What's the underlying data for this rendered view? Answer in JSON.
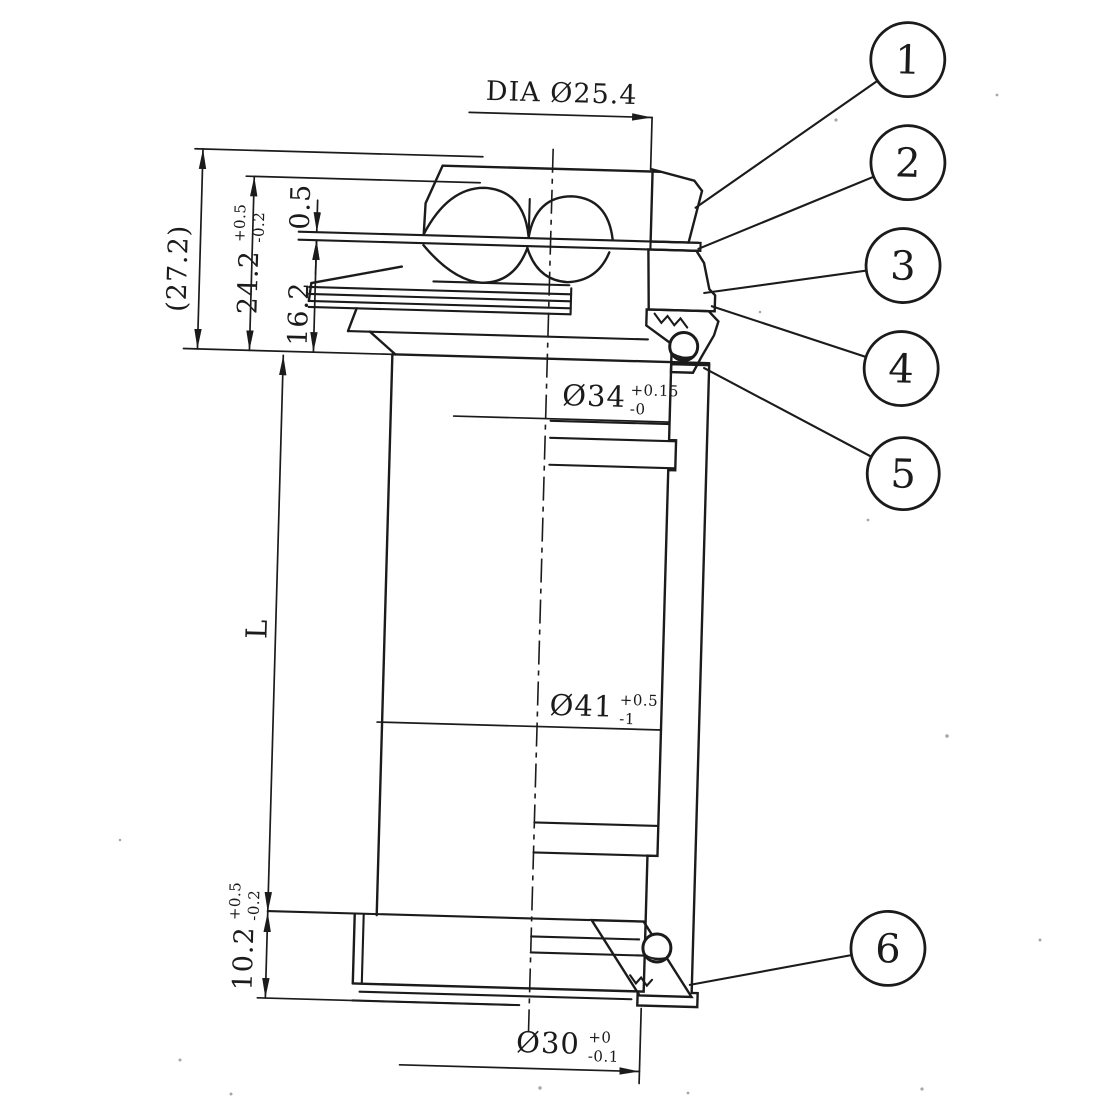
{
  "dimensions": {
    "dia_label": "DIA Ø25.4",
    "overall": "(27.2)",
    "upper_stack": {
      "value": "24.2",
      "tol_plus": "+0.5",
      "tol_minus": "-0.2"
    },
    "washer": "0.5",
    "upper_race": "16.2",
    "length": "L",
    "lower_stack": {
      "value": "10.2",
      "tol_plus": "+0.5",
      "tol_minus": "-0.2"
    },
    "bore_top": {
      "value": "Ø34",
      "tol_plus": "+0.15",
      "tol_minus": "-0"
    },
    "bore_mid": {
      "value": "Ø41",
      "tol_plus": "+0.5",
      "tol_minus": "-1"
    },
    "bore_bottom": {
      "value": "Ø30",
      "tol_plus": "+0",
      "tol_minus": "-0.1"
    }
  },
  "callouts": [
    {
      "number": "1"
    },
    {
      "number": "2"
    },
    {
      "number": "3"
    },
    {
      "number": "4"
    },
    {
      "number": "5"
    },
    {
      "number": "6"
    }
  ],
  "colors": {
    "ink": "#1b1b1b",
    "paper": "#ffffff"
  }
}
